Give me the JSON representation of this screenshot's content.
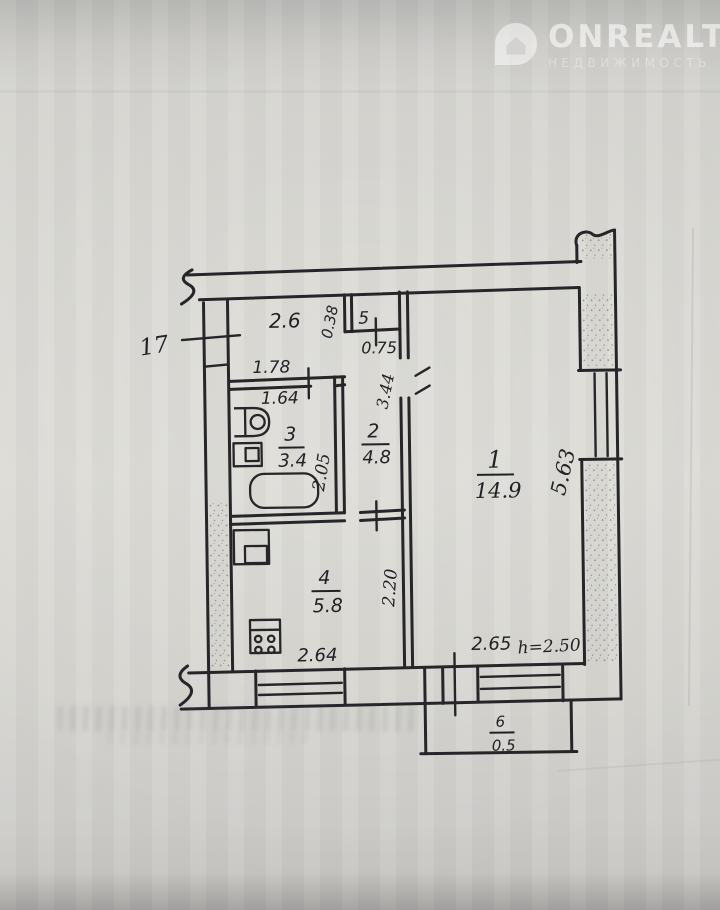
{
  "watermark": {
    "brand": "ONREALT",
    "subtitle": "НЕДВИЖИМОСТЬ"
  },
  "plan": {
    "apartment_note": "17",
    "height_note": "h=2.50",
    "rooms": [
      {
        "number": "1",
        "area": "14.9"
      },
      {
        "number": "2",
        "area": "4.8"
      },
      {
        "number": "3",
        "area": "3.4"
      },
      {
        "number": "4",
        "area": "5.8"
      },
      {
        "number": "5",
        "area": "0.75"
      },
      {
        "number": "6",
        "area": "0.5"
      }
    ],
    "dimensions": {
      "hall_top_width": "2.6",
      "closet_side": "0.38",
      "bath_outer_width": "1.78",
      "bath_inner_width": "1.64",
      "bath_depth": "2.05",
      "hall_length": "3.44",
      "room1_length": "5.63",
      "room1_width": "2.65",
      "kitchen_depth": "2.20",
      "kitchen_width": "2.64"
    }
  }
}
